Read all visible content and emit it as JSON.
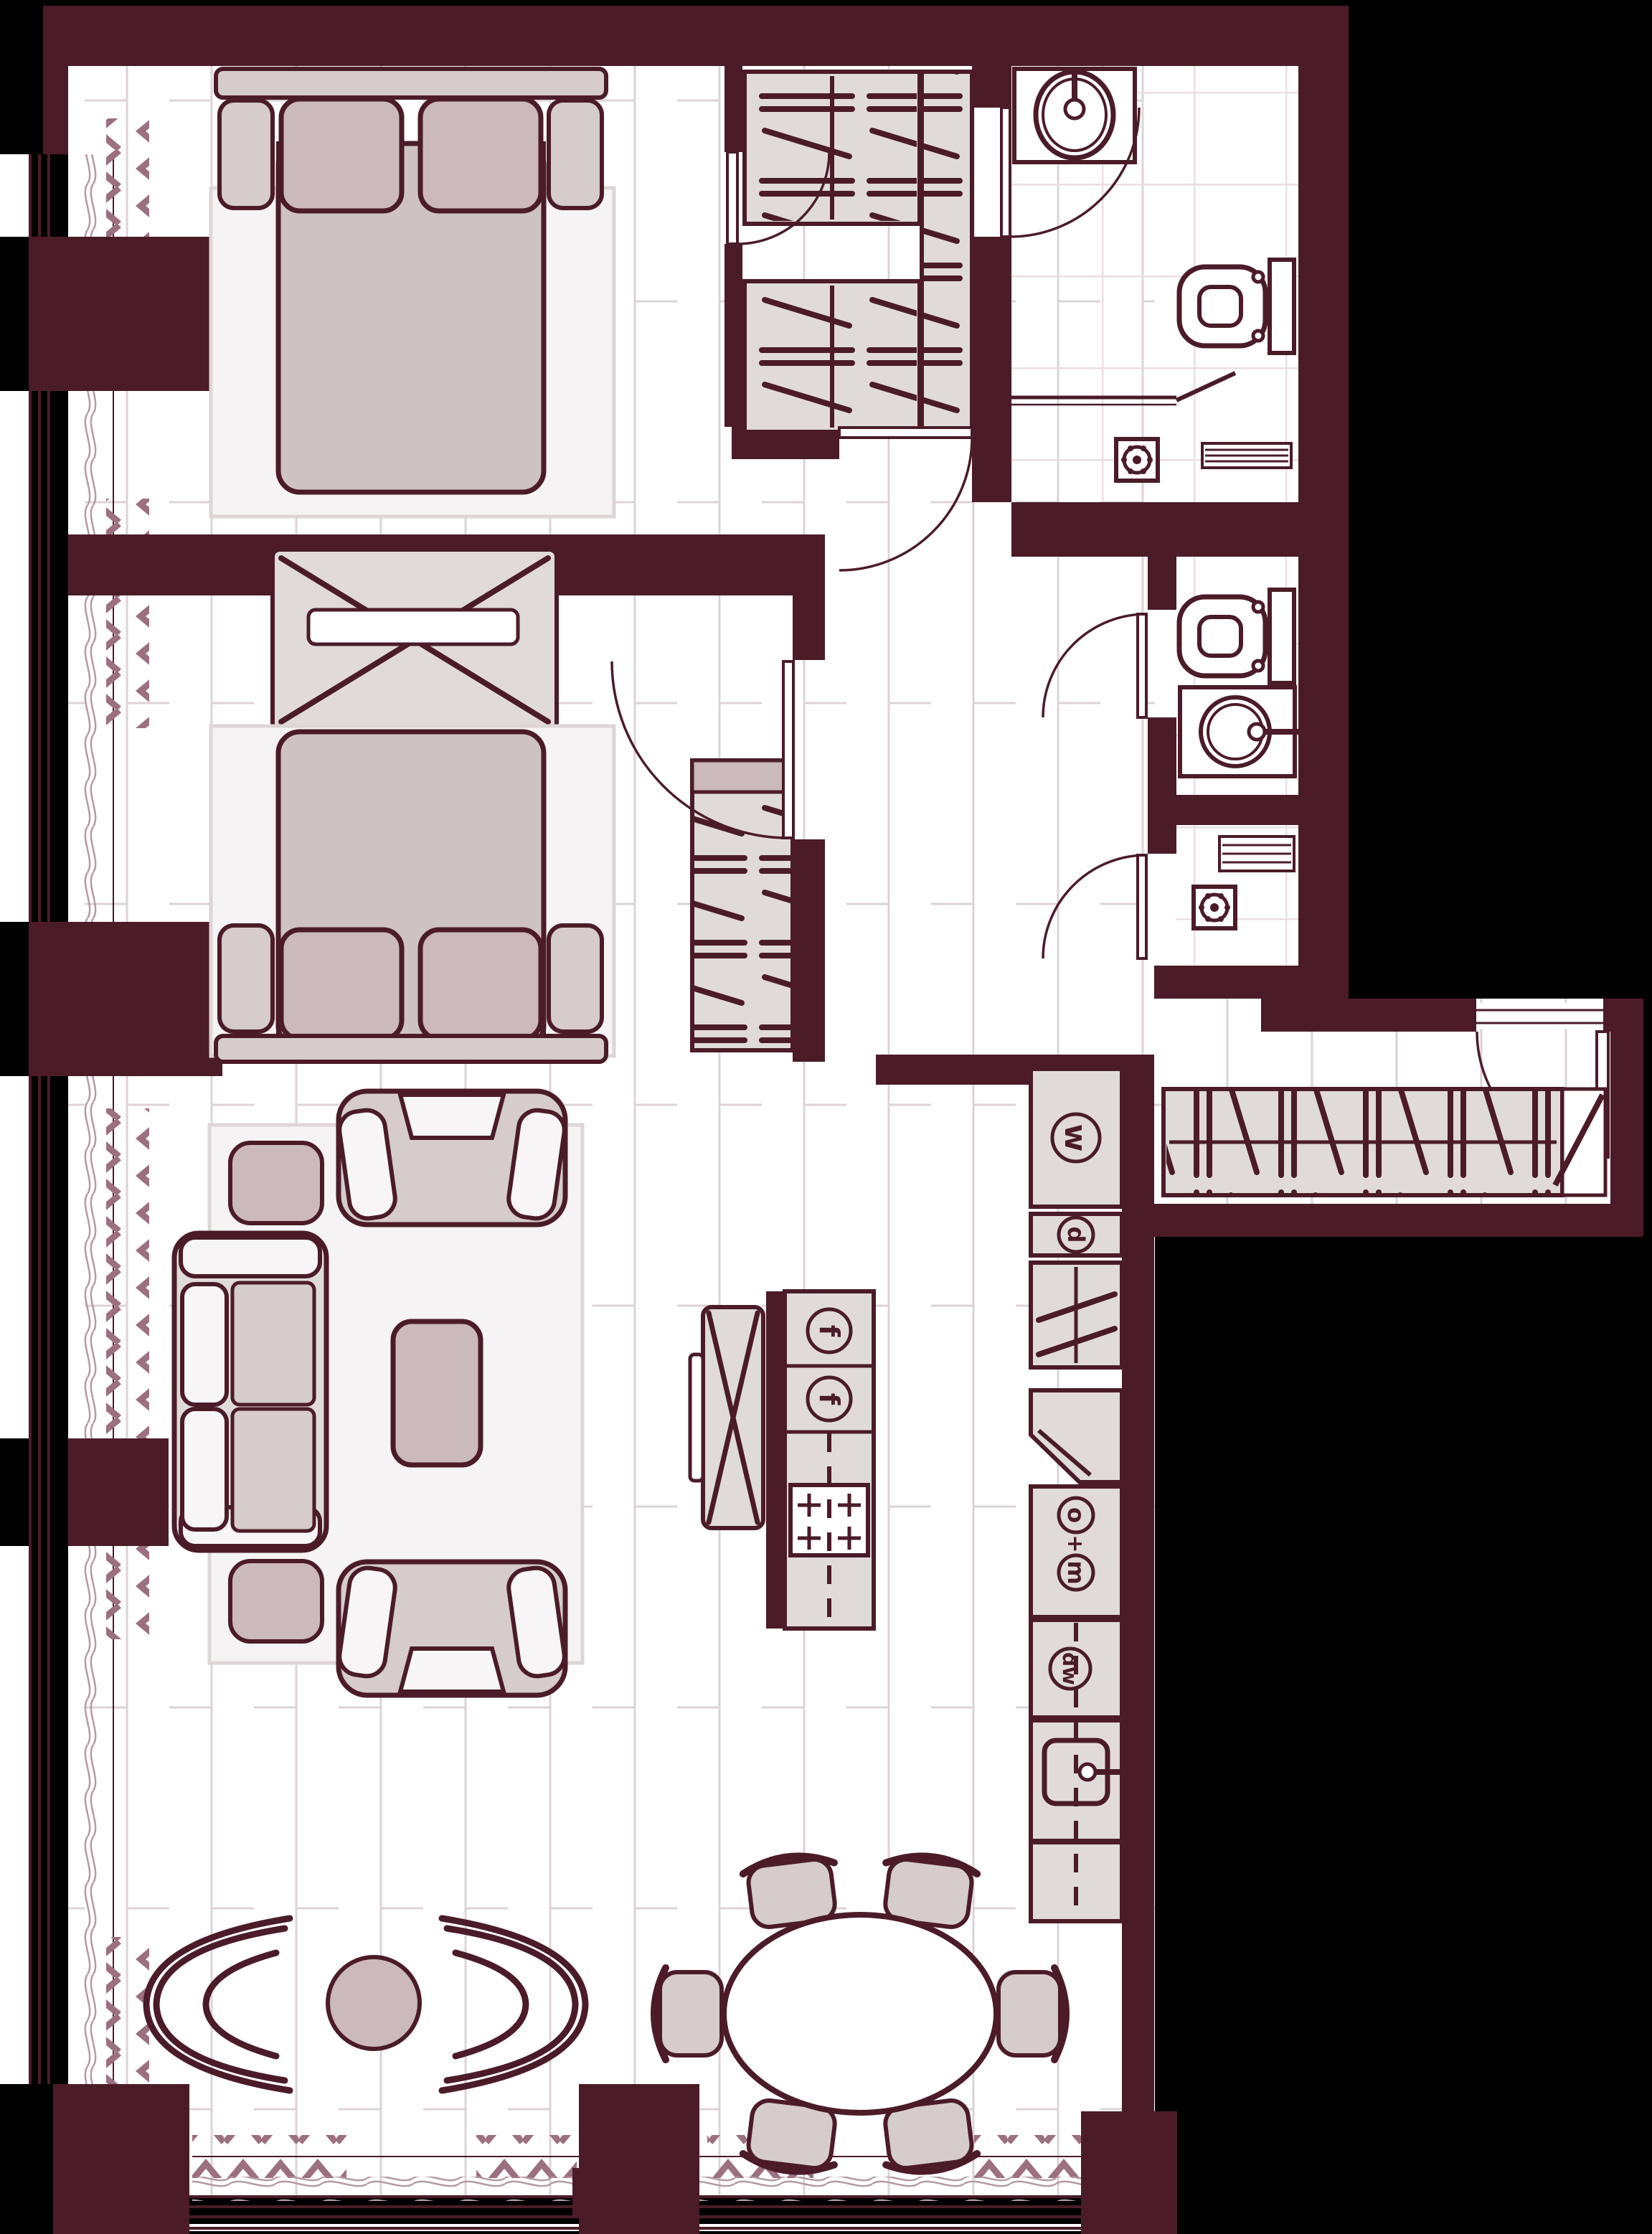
{
  "palette": {
    "outside": "#000000",
    "wall": "#4b1c28",
    "floor": "#ffffff",
    "plank": "#ddd3d6",
    "tile": "#eadfe2",
    "furn": "#e0dbda",
    "mid": "#d5cccb",
    "accent": "#cbb9bb",
    "cushion": "#f7f5f5",
    "blanket": "#cfc2c3",
    "rug": "#f5f3f3",
    "rugline": "#ded6d6",
    "curtain": "#9c7080",
    "sheer": "#b59aa2"
  },
  "labels": {
    "fridge_top": "f",
    "fridge_bottom": "f",
    "washer": "w",
    "dryer": "d",
    "oven": "o",
    "plus": "+",
    "microwave": "m",
    "dishwasher": "dw"
  },
  "symbols": {
    "bed": "double-bed-with-pillows-and-folded-blanket",
    "wardrobe": "hanging-rail-wardrobe",
    "shelf_unit": "shelf-column-with-diagonal-braces",
    "coat_closet": "entry-open-closet-with-hangers",
    "sofa": "two-seat-sofa",
    "armchair": "lounge-armchair",
    "lounge_chair": "curved-butterfly-chair",
    "coffee_table": "rectangular-coffee-table",
    "side_table": "round-side-table",
    "pouf": "square-pouf",
    "dining_table": "oval-dining-table",
    "dining_chair": "curved-back-dining-chair",
    "island": "kitchen-island-with-cooktop",
    "tv": "tv-panel",
    "toilet": "wall-hung-toilet",
    "sink_oval": "oval-countertop-basin",
    "sink_round": "round-vessel-basin",
    "kitchen_sink": "square-kitchen-sink",
    "shower_drain": "shower-drain-rosette",
    "radiator": "towel-radiator",
    "curtains": "zigzag-curtain",
    "sheers": "wave-sheer-curtain",
    "door": "swing-door-with-arc",
    "window": "triple-line-glazing"
  }
}
